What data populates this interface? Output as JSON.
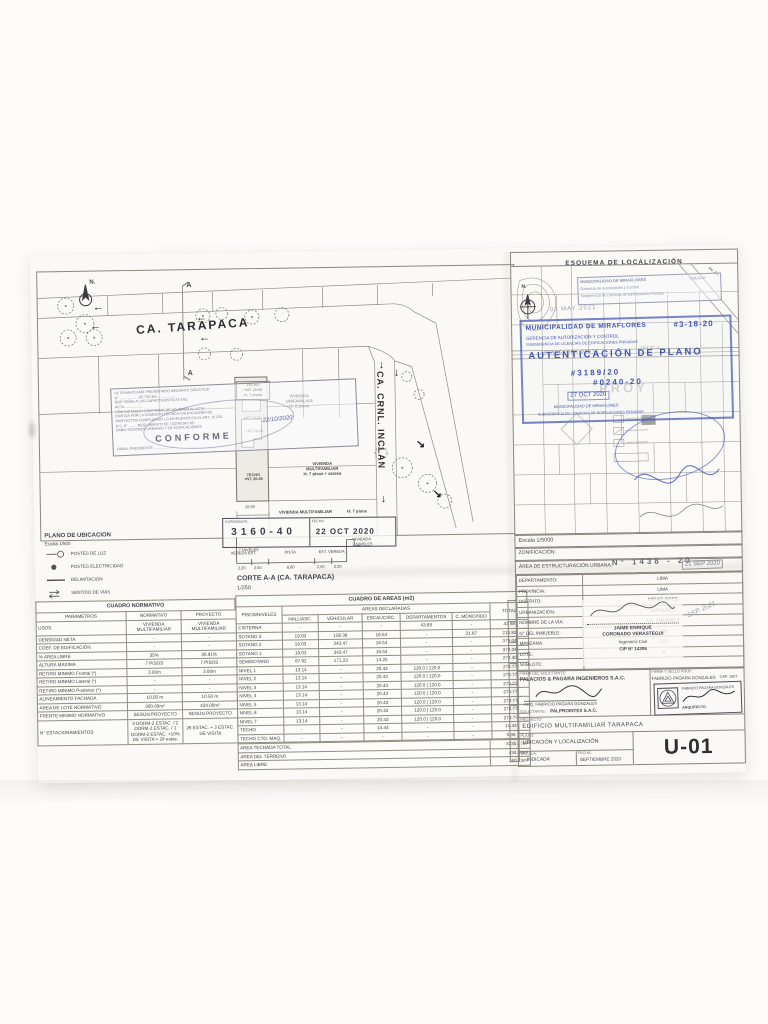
{
  "plan": {
    "title": "PLANO DE UBICACION",
    "scale": "Escala 1/500",
    "north": "N.",
    "street_h": "CA. TARAPACA",
    "street_v": "CA. CRNL. INCLAN",
    "section_marker": "A",
    "labels": {
      "techo_1": "TECHO\n+NT. 20.65\nH: 7 pisos",
      "unifamiliar": "VIVIENDA\nUNIFAMILIAR\nH: 2 pisos",
      "elev_2320": "+NT. 23.20",
      "elev_2040": "+NT. 20.40",
      "techo_2": "TECHO\n+NT. 20.65",
      "multifam_azotea": "VIVIENDA\nMULTIFAMILIAR\nH: 7 pisos + azotea",
      "multifam_7": "VIVIENDA MULTIFAMILIAR",
      "multifam_7_h": "H: 7 pisos",
      "dim_frente": "10.50"
    },
    "legend": [
      {
        "label": "POSTES DE LUZ"
      },
      {
        "label": "POSTES ELECTRICIDAD"
      },
      {
        "label": "DELIMITACIÓN"
      },
      {
        "label": "SENTIDO DE VÍAS"
      }
    ],
    "corte": {
      "title": "CORTE A-A (CA. TARAPACA)",
      "scale": "1/250",
      "left_label": "7 NIVELES",
      "right_label": "VIVIENDA\n2 NIVELES",
      "seg1": "VEREDA EST.",
      "seg2": "PISTA",
      "seg3": "EST. VEREDA",
      "d1": "2.20",
      "d2": "2.50",
      "d3": "6.80",
      "d4": "2.50",
      "d5": "2.20"
    },
    "conforme_stamp": {
      "body": "SE FIRMA PLANO PRESENTADO MEDIANTE SOLICITUD\nN° .................. DE FECHA ..................\nQUE SEÑALA LAS CARACTERISTICAS DEL\nACTA ..................\nCON DICTAMEN CONFORME DE ACUERDO AL ACTA\nEMITIDA POR LA COMISION TECNICA CALIFICADORA DE\nPROYECTOS CUMPLIENDO LO DISPUESTO EN EL ART. 10 DEL\nD.S. N° ........ REGLAMENTO DE LICENCIAS DE\nHABILITACIONES URBANAS Y DE EDIFICACIONES",
      "date_hand": "22/10/2020",
      "conforme": "CONFORME",
      "firma_line": "FIRMA: PRESIDENTE .......................",
      "exp_label": "EXPEDIENTE:",
      "exp_value": "3160-40",
      "fecha_label": "FECHA:",
      "fecha_value": "22 OCT 2020"
    }
  },
  "cuadro_normativo": {
    "title": "CUADRO NORMATIVO",
    "cols": [
      "PARAMETROS",
      "NORMATIVO",
      "PROYECTO"
    ],
    "rows": [
      [
        "USOS",
        "VIVIENDA\nMULTIFAMILIAR",
        "VIVIENDA\nMULTIFAMILIAR"
      ],
      [
        "DENSIDAD NETA",
        "-",
        "-"
      ],
      [
        "COEF. DE EDIFICACIÓN",
        "-",
        "-"
      ],
      [
        "% AREA LIBRE",
        "35%",
        "36.91%"
      ],
      [
        "ALTURA MAXIMA",
        "7 PISOS",
        "7 PISOS"
      ],
      [
        "RETIRO MINIMO   Frontal (*)",
        "3.00m",
        "3.00m"
      ],
      [
        "RETIRO MINIMO   Lateral (*)",
        "-",
        "-"
      ],
      [
        "RETIRO MINIMO   Posterior (*)",
        "-",
        "-"
      ],
      [
        "ALINEAMIENTO FACHADA",
        "10.50 m",
        "10.50 m"
      ],
      [
        "AREA DE LOTE NORMATIVO",
        "300.00m²",
        "434.00m²"
      ],
      [
        "FRENTE MINIMO NORMATIVO",
        "SEGÚN PROYECTO",
        "SEGÚN PROYECTO"
      ],
      [
        "N° ESTACIONAMIENTOS",
        "3 DORM-2 ESTAC. / 2 DORM-2 ESTAC. / 1 DORM-2 ESTAC. +10% DE VISITA = 24 estac.",
        "26 ESTAC. + 3 ESTAC. DE VISITA"
      ]
    ]
  },
  "cuadro_areas": {
    "title": "CUADRO DE AREAS (m2)",
    "group_header": "AREAS DECLARADAS",
    "col_pisos": "PISOS/NIVELES",
    "col_total": "TOTAL",
    "cols": [
      "HALL/ASC.",
      "VEHICULAR",
      "ESCAL/CIRC.",
      "DEPARTAMENTOS",
      "C. MONOXIDO"
    ],
    "rows": [
      [
        "CISTERNA",
        "-",
        "-",
        "-",
        "43.68",
        "-",
        "43.68"
      ],
      [
        "SOTANO 3",
        "19.03",
        "156.38",
        "16.54",
        "-",
        "21.87",
        "213.82"
      ],
      [
        "SOTANO 2",
        "19.03",
        "343.47",
        "16.54",
        "-",
        "-",
        "379.04"
      ],
      [
        "SOTANO 1",
        "19.03",
        "343.47",
        "16.54",
        "-",
        "-",
        "379.04"
      ],
      [
        "SEMISOTANO",
        "87.92",
        "171.23",
        "14.25",
        "-",
        "-",
        "273.40"
      ],
      [
        "NIVEL 1",
        "13.14",
        "-",
        "20.43",
        "120.0 | 120.0",
        "-",
        "273.77"
      ],
      [
        "NIVEL 2",
        "13.14",
        "-",
        "20.43",
        "120.0 | 120.0",
        "-",
        "273.77"
      ],
      [
        "NIVEL 3",
        "13.14",
        "-",
        "20.43",
        "120.0 | 120.0",
        "-",
        "273.77"
      ],
      [
        "NIVEL 4",
        "13.14",
        "-",
        "20.43",
        "120.0 | 120.0",
        "-",
        "273.77"
      ],
      [
        "NIVEL 5",
        "13.14",
        "-",
        "20.43",
        "120.0 | 120.0",
        "-",
        "273.77"
      ],
      [
        "NIVEL 6",
        "13.14",
        "-",
        "20.43",
        "120.0 | 120.0",
        "-",
        "273.77"
      ],
      [
        "NIVEL 7",
        "13.14",
        "-",
        "20.43",
        "120.0 | 120.0",
        "-",
        "273.77"
      ],
      [
        "TECHO",
        "-",
        "-",
        "14.44",
        "-",
        "-",
        "14.44"
      ],
      [
        "TECHO CTO. MAQ.",
        "-",
        "-",
        "-",
        "-",
        "-",
        "5.36"
      ]
    ],
    "totals": [
      [
        "AREA TECHADA TOTAL",
        "3235.17m²"
      ],
      [
        "AREA DEL TERRENO",
        "434.00m²"
      ],
      [
        "AREA LIBRE",
        "160.23m²"
      ]
    ]
  },
  "esquema": {
    "title": "ESQUEMA DE LOCALIZACIÓN",
    "north": "N.",
    "map": {
      "av1": "AV. ANGAMOS OESTE",
      "av2": "AV. AN.",
      "ley": "LEY N° 2....",
      "proy": "PROY"
    },
    "stamps": {
      "gray_line1": "MUNICIPALIDAD DE MIRAFLORES",
      "gray_folio": "FOLIO N°",
      "gray_line2": "Gerencia de Autorización y Control",
      "gray_line3": "Subgerencia de Licencias de Edificaciones Privadas",
      "gray_date": "03 MAY 2021",
      "blue_muni": "MUNICIPALIDAD DE MIRAFLORES",
      "blue_num": "#3-18-20",
      "blue_ger": "GERENCIA DE AUTORIZACIÓN Y CONTROL",
      "blue_sub": "SUBGERENCIA DE LICENCIAS DE EDIFICACIONES PRIVADAS",
      "blue_auth": "AUTENTICACIÓN DE PLANO",
      "blue_exp1": "#3189/20",
      "blue_exp2": "#0240-20",
      "blue_date": "27 OCT 2020",
      "blue_foot1": "MUNICIPALIDAD DE MIRAFLORES",
      "blue_foot2": "SUBGERENCIA DE LICENCIAS DE EDIFICACIONES PRIVADAS",
      "area_num": "N° 1438 - 20",
      "area_date": "21 SEP 2020",
      "hand_note": "SEP. 2021"
    },
    "escala_row": "Escala 1/5000",
    "zonificacion_label": "ZONIFICACIÓN:",
    "area_urbana_label": "ÁREA DE ESTRUCTURACIÓN URBANA:",
    "fields": [
      [
        "DEPARTAMENTO:",
        "LIMA"
      ],
      [
        "PROVINCIA:",
        "LIMA"
      ],
      [
        "DISTRITO:",
        "MIRAFLORES"
      ],
      [
        "URBANIZACIÓN:",
        "SURQUILLO"
      ],
      [
        "NOMBRE DE LA VÍA:",
        "CA. TARAPACA"
      ],
      [
        "N° DEL INMUEBLE:",
        "230"
      ],
      [
        "MANZANA:",
        "155"
      ],
      [
        "LOTE:",
        "8"
      ],
      [
        "SUBLOTE:",
        "-"
      ]
    ],
    "engineer": {
      "name": "JAIME ENRIQUE\nCORONADO VERASTEGUI",
      "title": "Ingeniero Civil",
      "cip": "CIP N° 14306"
    }
  },
  "title_block": {
    "firma_solicitante_label": "FIRMA DEL SOLICITANTE:",
    "company": "PALACIOS & PAGARA INGENIEROS S.A.C.",
    "company_rep": "ARQ. FABRICIO PAGARA GONZALES",
    "solicitante_label": "SOLICITANTE:",
    "solicitante": "PALPROINTEX S.A.C.",
    "firma_prof_label": "FIRMA Y SELLO PROF.:",
    "professional": "FABRIZIO PAGARA GONZALES",
    "cap": "CAP. 1607",
    "stamp_name": "FABRIZIO PAGARA GONZALES",
    "stamp_title": "ARQUITECTO",
    "proyecto_label": "PROYECTO:",
    "proyecto": "EDIFICIO MULTIFAMILIAR TARAPACA",
    "plano_label": "PLANO:",
    "plano": "UBICACIÓN Y LOCALIZACIÓN",
    "escala_label": "ESCALA:",
    "escala": "INDICADA",
    "fecha_label": "FECHA:",
    "fecha": "SEPTIEMBRE 2020",
    "sheet_no": "U-01"
  }
}
